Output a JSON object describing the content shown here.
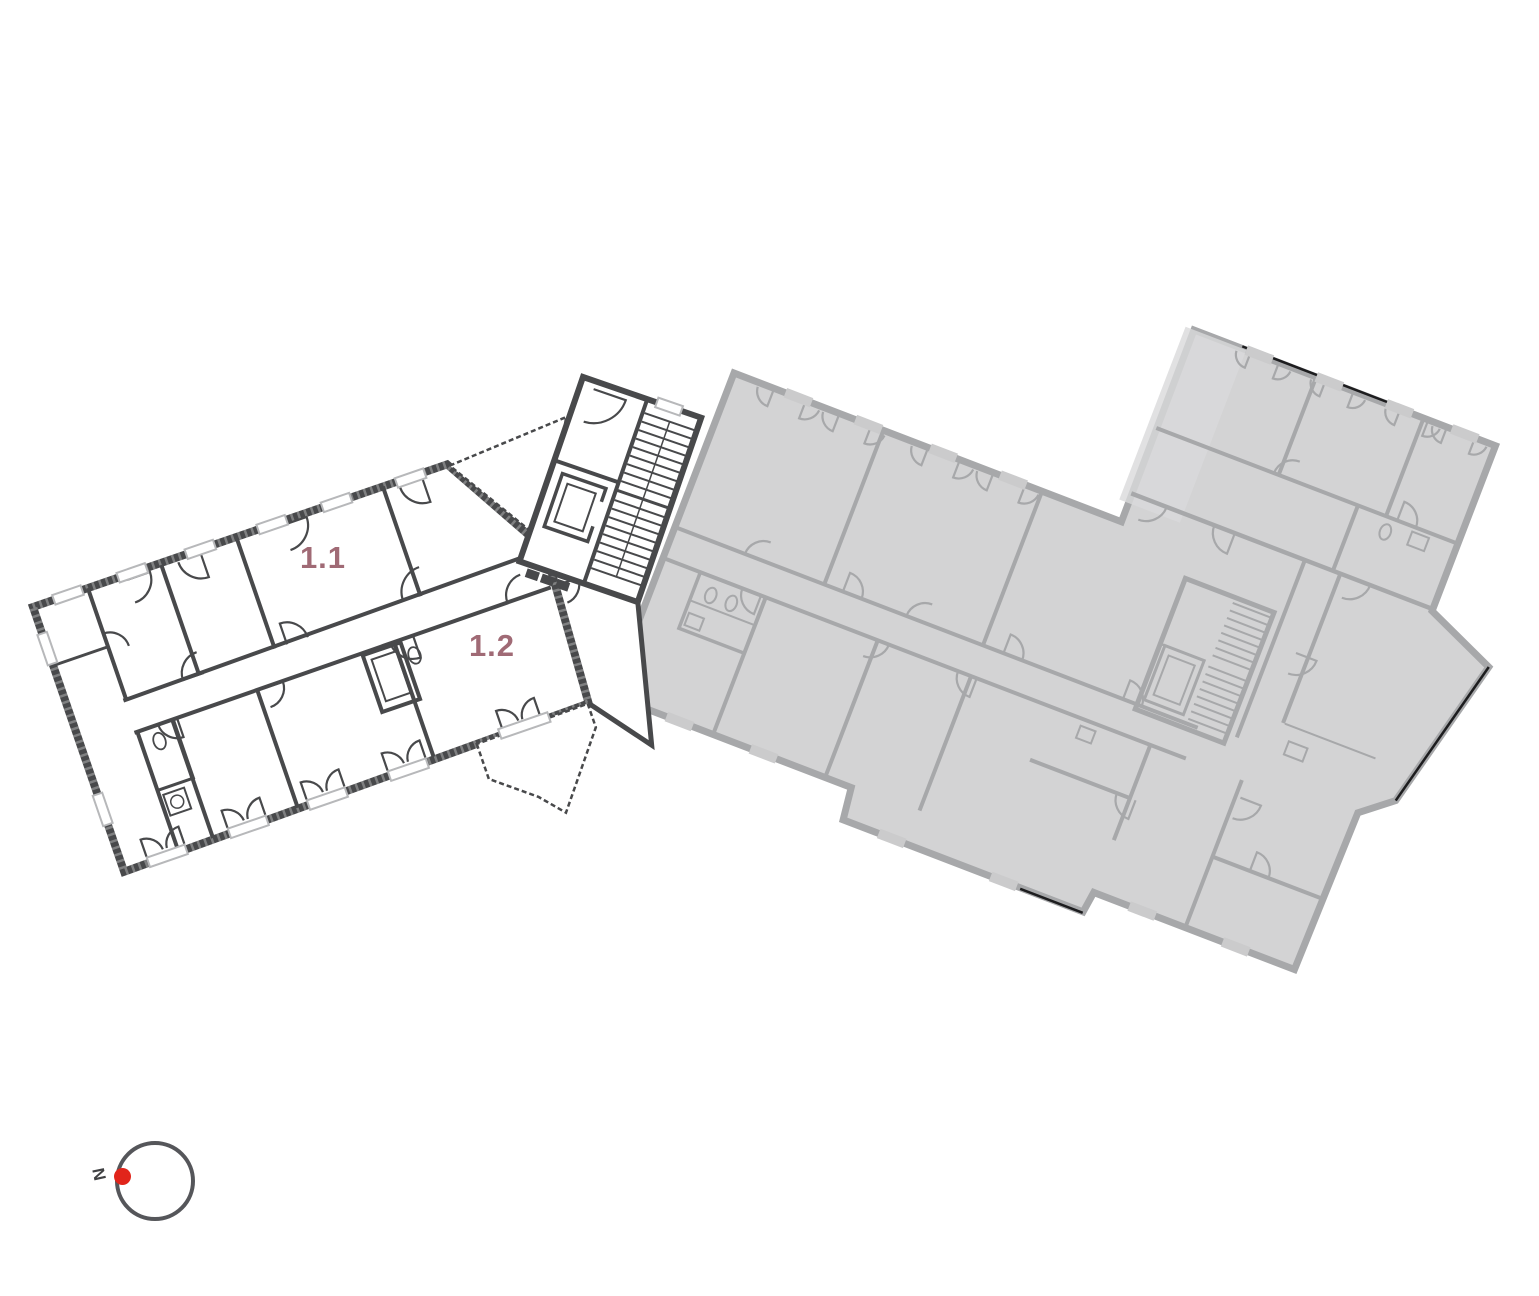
{
  "page": {
    "background_color": "#ffffff"
  },
  "floor_plan": {
    "units": [
      {
        "id": "1.1",
        "label": "1.1"
      },
      {
        "id": "1.2",
        "label": "1.2"
      }
    ],
    "unit_label_color": "#a06a75",
    "active_wall_color": "#48494b",
    "active_fill_color": "#ffffff",
    "window_marker_color": "#b7b8ba",
    "inactive_fill_color": "#d3d3d4",
    "inactive_wall_color": "#a7a8aa",
    "inactive_accent_color": "#1d1d1f"
  },
  "compass": {
    "north_label": "N",
    "ring_color": "#55565a",
    "dot_color": "#e1251b"
  }
}
